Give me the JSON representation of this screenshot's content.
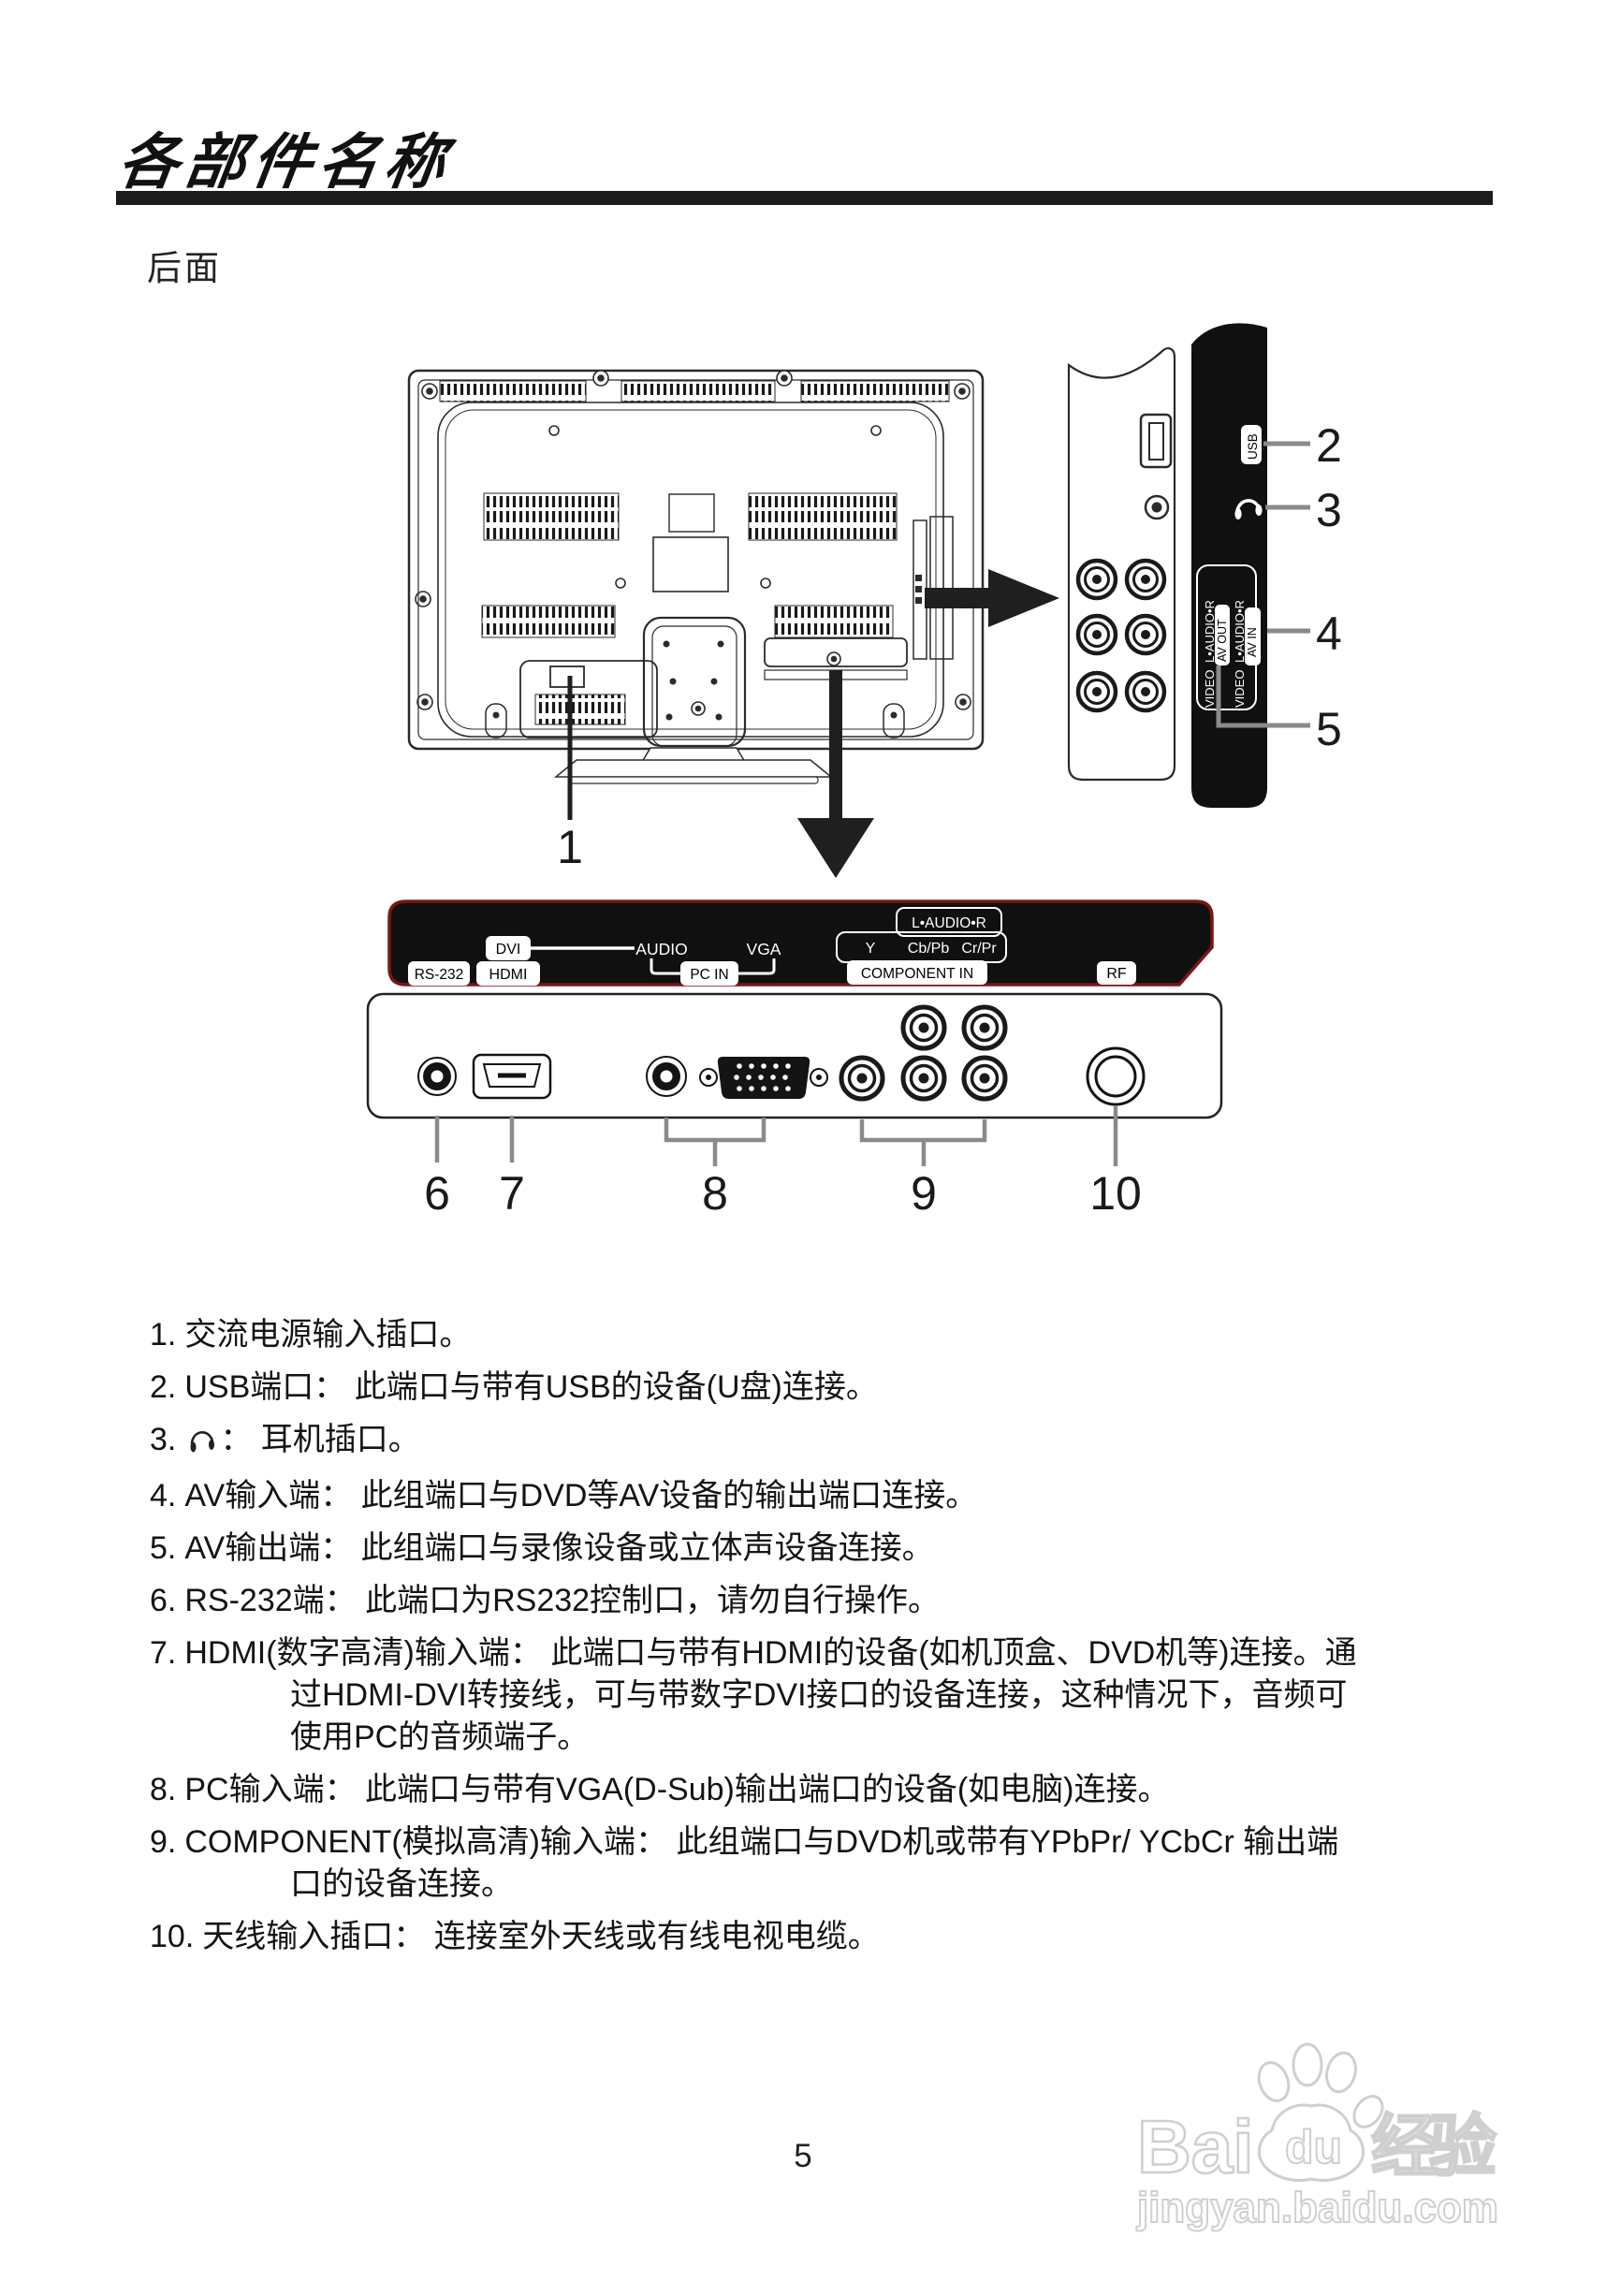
{
  "page": {
    "title": "各部件名称",
    "section_label": "后面",
    "page_number": "5"
  },
  "colors": {
    "panel_red_border": "#7a1517",
    "panel_black": "#101010",
    "leader_gray": "#8a8a8a",
    "watermark_gray": "#cfcfcf"
  },
  "callouts": [
    "1",
    "2",
    "3",
    "4",
    "5",
    "6",
    "7",
    "8",
    "9",
    "10"
  ],
  "side_panel": {
    "usb": "USB",
    "av_out": {
      "video": "VIDEO",
      "audio": "L•AUDIO•R",
      "label": "AV OUT"
    },
    "av_in": {
      "video": "VIDEO",
      "audio": "L•AUDIO•R",
      "label": "AV IN"
    }
  },
  "bottom_panel": {
    "rs232": "RS-232",
    "hdmi": "HDMI",
    "dvi": "DVI",
    "audio": "AUDIO",
    "vga": "VGA",
    "pc_in": "PC IN",
    "component_audio": "L•AUDIO•R",
    "y": "Y",
    "cb": "Cb/Pb",
    "cr": "Cr/Pr",
    "component_in": "COMPONENT IN",
    "rf": "RF"
  },
  "list": {
    "items": [
      {
        "num": "1.",
        "lines": [
          "交流电源输入插口。"
        ]
      },
      {
        "num": "2.",
        "lines": [
          "USB端口： 此端口与带有USB的设备(U盘)连接。"
        ]
      },
      {
        "num": "3.",
        "lines": [
          "： 耳机插口。"
        ]
      },
      {
        "num": "4.",
        "lines": [
          "AV输入端： 此组端口与DVD等AV设备的输出端口连接。"
        ]
      },
      {
        "num": "5.",
        "lines": [
          "AV输出端： 此组端口与录像设备或立体声设备连接。"
        ]
      },
      {
        "num": "6.",
        "lines": [
          "RS-232端： 此端口为RS232控制口，请勿自行操作。"
        ]
      },
      {
        "num": "7.",
        "lines": [
          "HDMI(数字高清)输入端： 此端口与带有HDMI的设备(如机顶盒、DVD机等)连接。通",
          "过HDMI-DVI转接线，可与带数字DVI接口的设备连接，这种情况下，音频可",
          "使用PC的音频端子。"
        ]
      },
      {
        "num": "8.",
        "lines": [
          "PC输入端： 此端口与带有VGA(D-Sub)输出端口的设备(如电脑)连接。"
        ]
      },
      {
        "num": "9.",
        "lines": [
          "COMPONENT(模拟高清)输入端： 此组端口与DVD机或带有YPbPr/ YCbCr 输出端",
          "口的设备连接。"
        ]
      },
      {
        "num": "10.",
        "lines": [
          "天线输入插口： 连接室外天线或有线电视电缆。"
        ]
      }
    ]
  },
  "watermark": {
    "bai": "Bai",
    "du": "du",
    "cn": "经验",
    "url": "jingyan.baidu.com"
  }
}
